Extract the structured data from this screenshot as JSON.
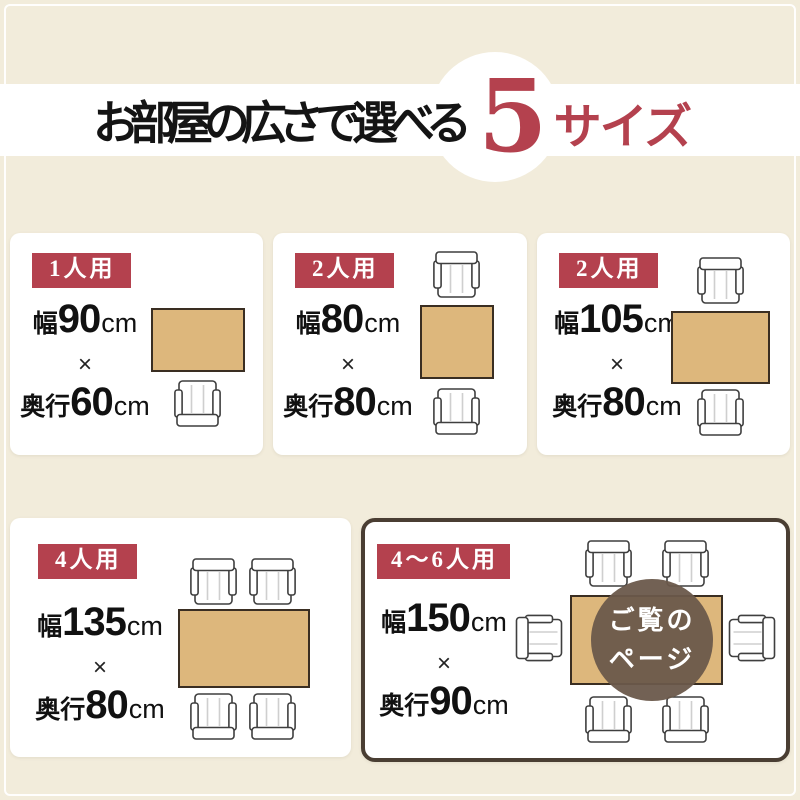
{
  "title": {
    "prefix": "お部屋の広さで選べる",
    "count": "5",
    "suffix": "サイズ"
  },
  "separator": "×",
  "unit": "cm",
  "cards": [
    {
      "badge": "1人用",
      "width_label": "幅",
      "width_value": "90",
      "depth_label": "奥行",
      "depth_value": "60",
      "chairs": 1
    },
    {
      "badge": "2人用",
      "width_label": "幅",
      "width_value": "80",
      "depth_label": "奥行",
      "depth_value": "80",
      "chairs": 2
    },
    {
      "badge": "2人用",
      "width_label": "幅",
      "width_value": "105",
      "depth_label": "奥行",
      "depth_value": "80",
      "chairs": 2
    },
    {
      "badge": "4人用",
      "width_label": "幅",
      "width_value": "135",
      "depth_label": "奥行",
      "depth_value": "80",
      "chairs": 4
    },
    {
      "badge": "4〜6人用",
      "width_label": "幅",
      "width_value": "150",
      "depth_label": "奥行",
      "depth_value": "90",
      "chairs": 6
    }
  ],
  "current_page_badge": {
    "line1": "ご覧の",
    "line2": "ページ"
  },
  "colors": {
    "background": "#f2ecdb",
    "band": "#ffffff",
    "accent_red": "#b4414e",
    "text_black": "#141414",
    "table_wood": "#ddb77c",
    "highlight_border": "#4a3e33",
    "page_badge_brown": "#6a594b"
  }
}
